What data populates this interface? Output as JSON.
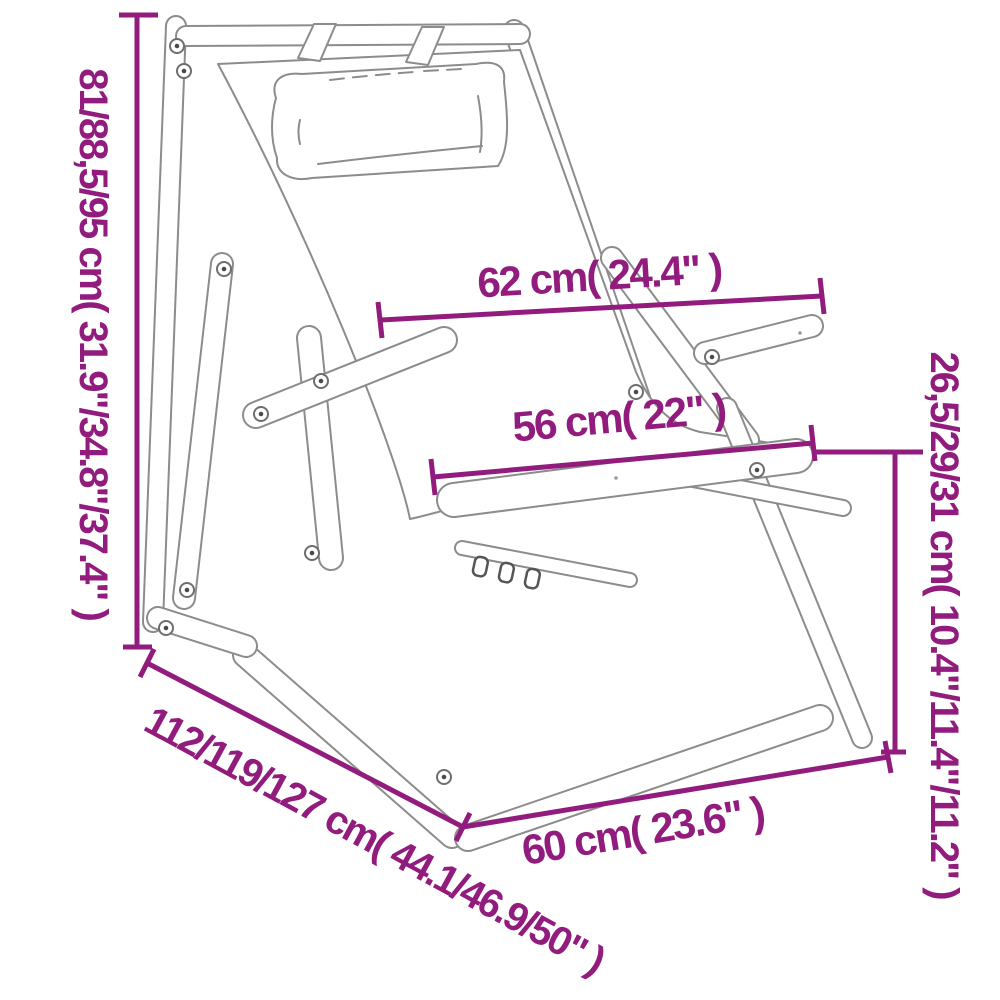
{
  "title": "Folding deck chair with pillow - dimension diagram",
  "colors": {
    "dimension_accent": "#921c7e",
    "drawing_line": "#8c8c8c",
    "background": "#ffffff"
  },
  "dimensions": {
    "height": {
      "label": "81/88,5/95 cm( 31.9\"/34.8\"/37.4\" )",
      "orientation": "vertical-left"
    },
    "top_width": {
      "label": "62 cm( 24.4\" )",
      "orientation": "horizontal-top"
    },
    "seat_width": {
      "label": "56 cm( 22\" )",
      "orientation": "horizontal-middle"
    },
    "armrest_height": {
      "label": "26,5/29/31 cm( 10.4\"/11.4\"/11.2\" )",
      "orientation": "vertical-right"
    },
    "total_depth": {
      "label": "112/119/127 cm( 44.1/46.9/50\" )",
      "orientation": "diagonal-bottom-left"
    },
    "base_width": {
      "label": "60 cm( 23.6\" )",
      "orientation": "horizontal-bottom"
    }
  }
}
